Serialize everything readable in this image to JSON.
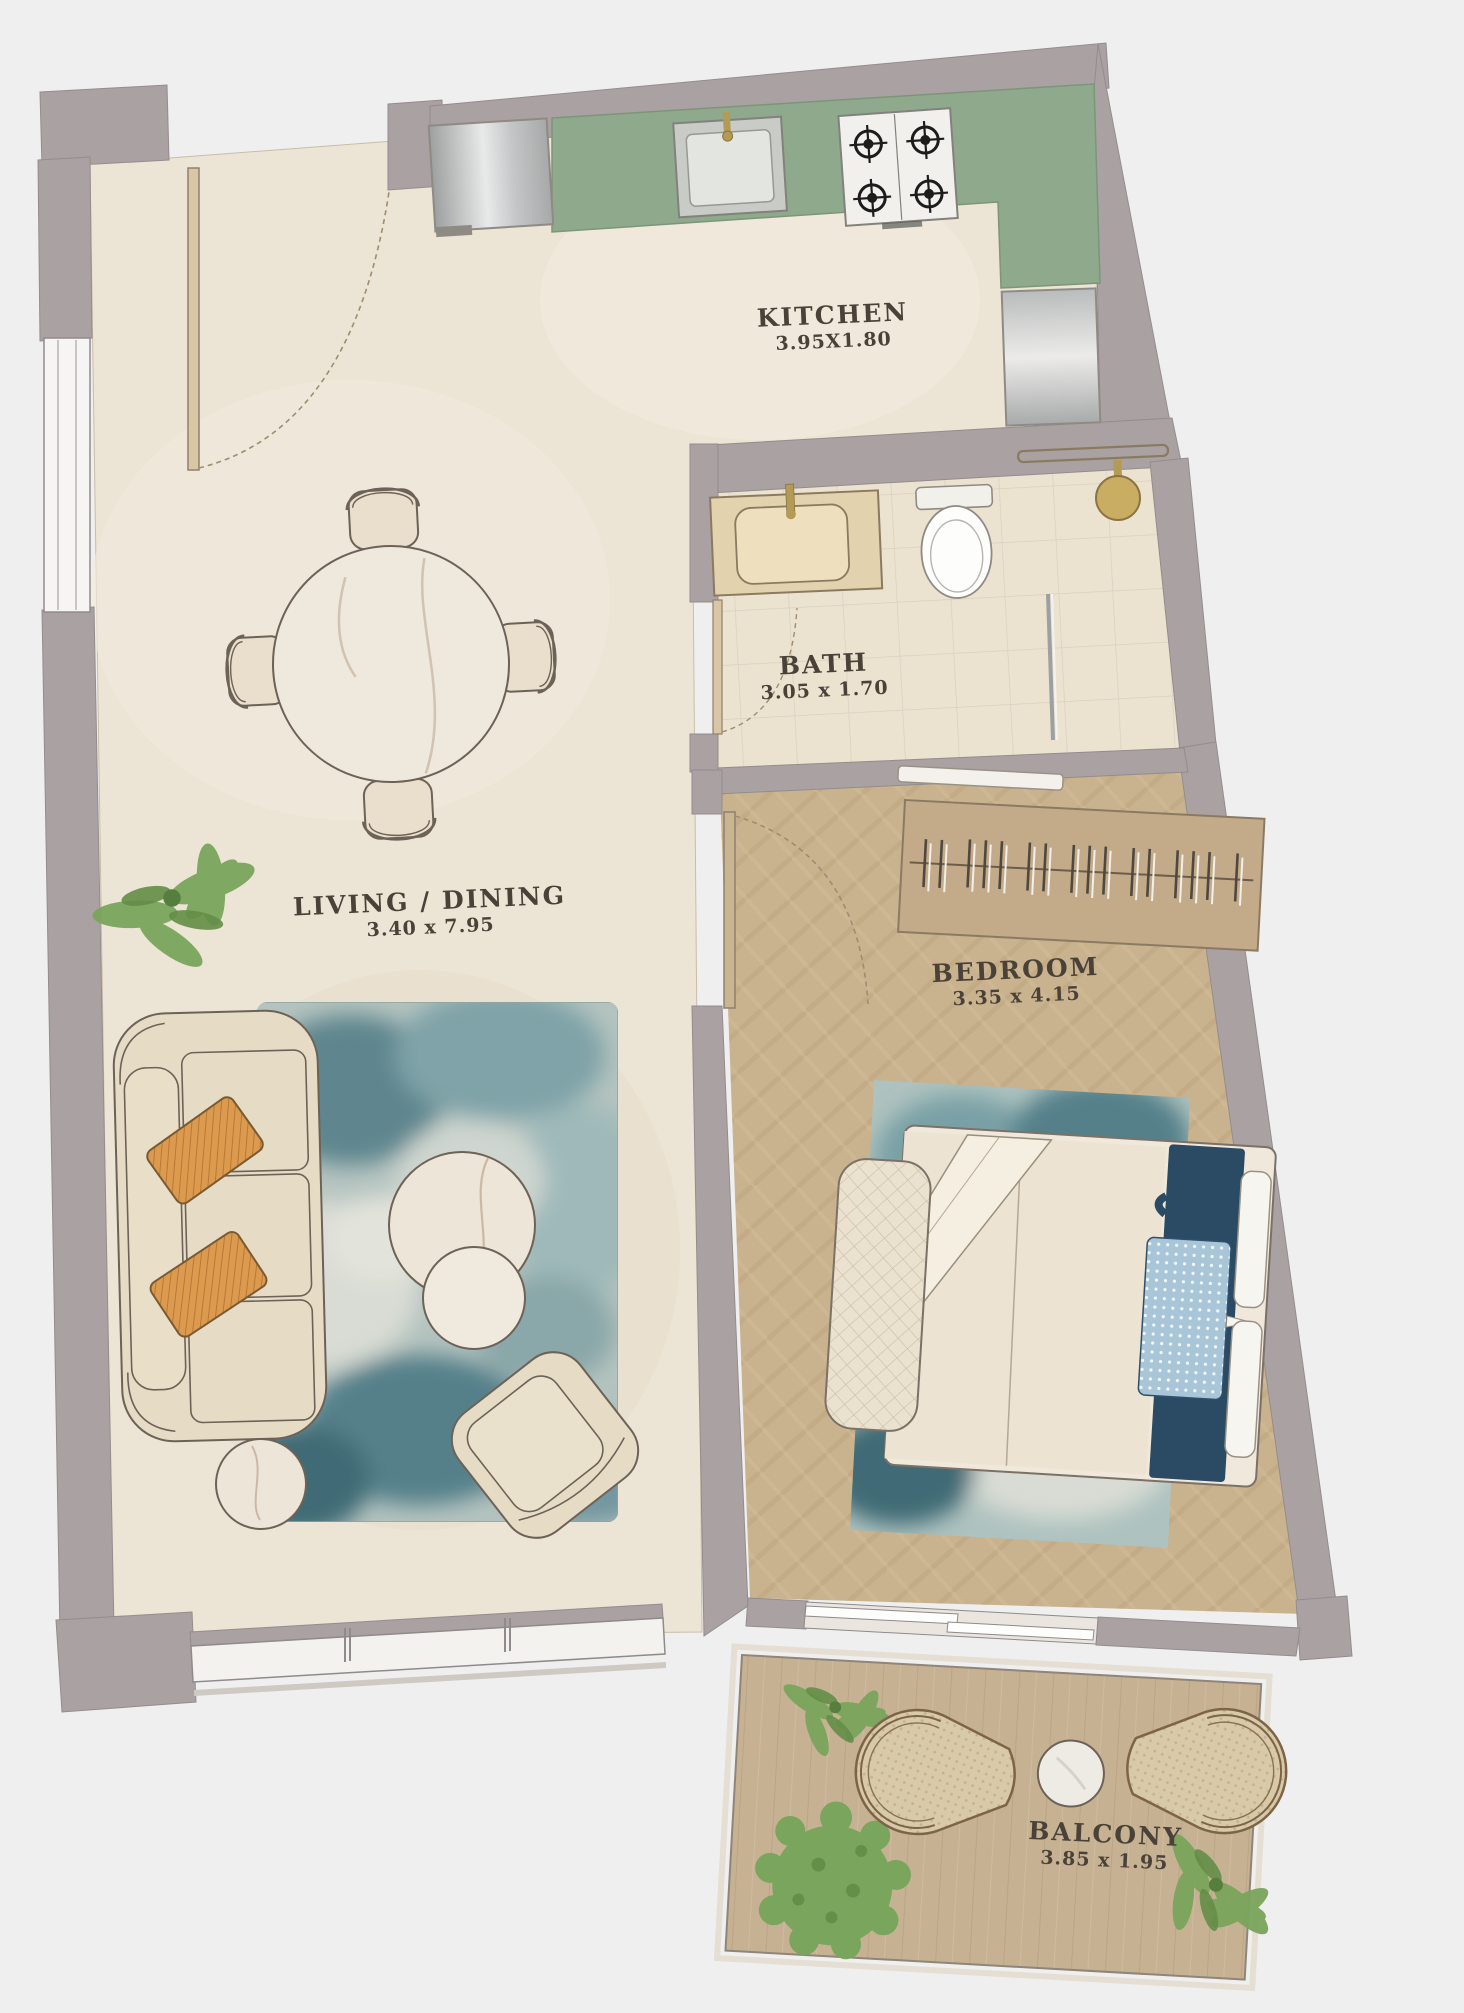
{
  "page": {
    "type": "apartment-floor-plan",
    "background": "#efeff0"
  },
  "rooms": [
    {
      "id": "kitchen",
      "label": "KITCHEN",
      "dims": "3.95X1.80"
    },
    {
      "id": "bath",
      "label": "BATH",
      "dims": "3.05 x 1.70"
    },
    {
      "id": "living_dining",
      "label": "LIVING / DINING",
      "dims": "3.40 x 7.95"
    },
    {
      "id": "bedroom",
      "label": "BEDROOM",
      "dims": "3.35 x 4.15"
    },
    {
      "id": "balcony",
      "label": "BALCONY",
      "dims": "3.85 x 1.95"
    }
  ],
  "colors": {
    "wall": "#a9a1a2",
    "floor_cream": "#ece4d4",
    "floor_wood": "#c9b28e",
    "balcony_deck": "#c6b293",
    "counter_green": "#8fa98c",
    "rug_teal": "#7f9fa3",
    "bed_runner_navy": "#2b4a63",
    "cushion_orange": "#dc9a4f",
    "plant_green": "#7aa55c",
    "label_text": "#4a4238"
  },
  "furniture": [
    "entry-door",
    "dining-table",
    "dining-chairs",
    "sofa",
    "orange-cushions",
    "living-rug",
    "coffee-tables",
    "side-table",
    "armchair",
    "kitchen-fridge",
    "kitchen-counter",
    "kitchen-sink",
    "stove",
    "kitchen-appliance",
    "bath-vanity",
    "toilet",
    "shower",
    "towel-rail",
    "wardrobe-hangers",
    "double-bed",
    "bed-bench",
    "bedroom-rug",
    "balcony-chairs",
    "balcony-table",
    "plants"
  ]
}
